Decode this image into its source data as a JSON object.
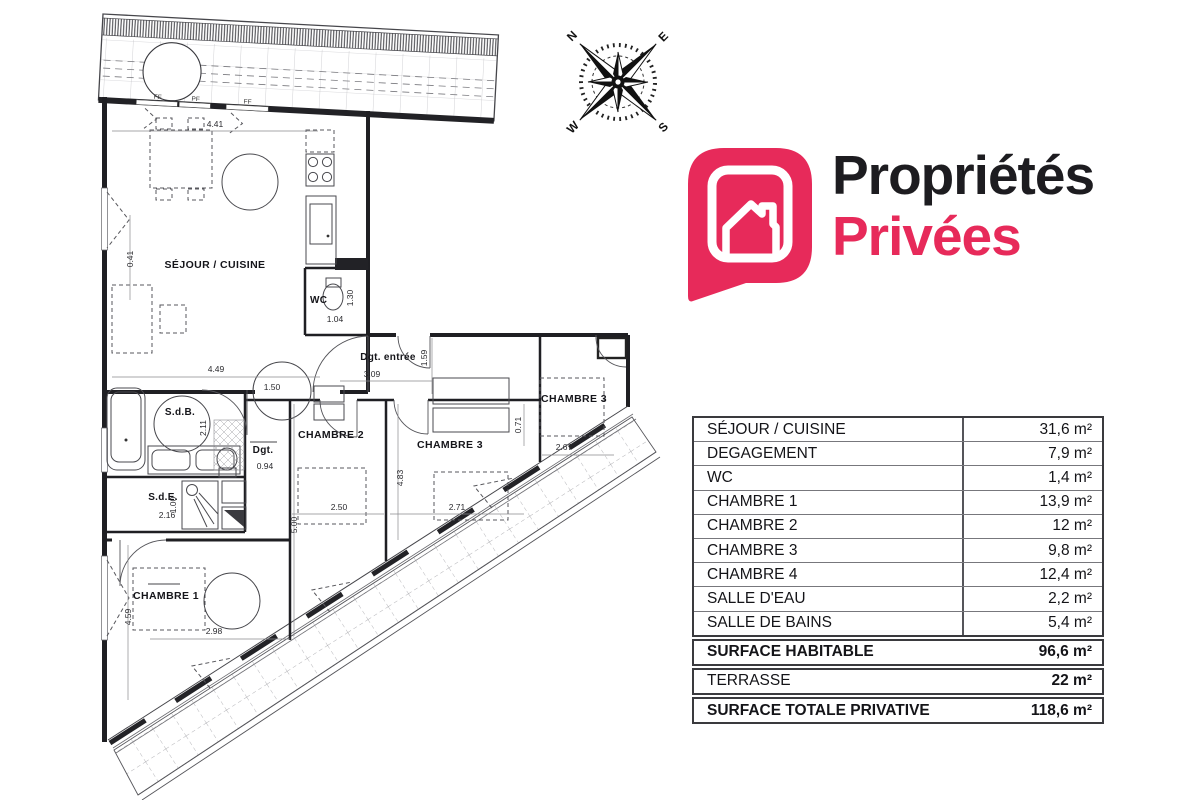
{
  "brand": {
    "name_line1": "Propriétés",
    "name_line2": "Privées",
    "primary_color": "#e72a5a",
    "text_color": "#1d1c20",
    "icon": "house-in-speech-bubble"
  },
  "compass": {
    "north": "N",
    "east": "E",
    "south": "S",
    "west": "W"
  },
  "plan": {
    "rooms": {
      "sejour": "SÉJOUR / CUISINE",
      "wc": "WC",
      "entry_hall": "Dgt. entrée",
      "bathroom": "S.d.B.",
      "hall": "Dgt.",
      "shower_room": "S.d.E.",
      "bedroom1": "CHAMBRE 1",
      "bedroom2": "CHAMBRE 2",
      "bedroom3": "CHAMBRE 3",
      "bedroom4": "CHAMBRE 3"
    },
    "dimensions": {
      "d441": "4.41",
      "d041": "0.41",
      "d449": "4.49",
      "d104": "1.04",
      "d130": "1.30",
      "d309": "3.09",
      "d159": "1.59",
      "d150": "1.50",
      "d211": "2.11",
      "d094": "0.94",
      "d216": "2.16",
      "d100": "1.00",
      "d250": "2.50",
      "d500": "5.00",
      "d483": "4.83",
      "d271": "2.71",
      "d267": "2.67",
      "d071": "0.71",
      "d459": "4.59",
      "d298": "2.98"
    },
    "window_marks": {
      "ff1": "FF",
      "pf": "PF",
      "ff2": "FF"
    }
  },
  "surface_table": {
    "unit": "m²",
    "rows": [
      {
        "label": "SÉJOUR / CUISINE",
        "value": "31,6 m²"
      },
      {
        "label": "DEGAGEMENT",
        "value": "7,9 m²"
      },
      {
        "label": "WC",
        "value": "1,4 m²"
      },
      {
        "label": "CHAMBRE 1",
        "value": "13,9 m²"
      },
      {
        "label": "CHAMBRE 2",
        "value": "12 m²"
      },
      {
        "label": "CHAMBRE 3",
        "value": "9,8 m²"
      },
      {
        "label": "CHAMBRE 4",
        "value": "12,4 m²"
      },
      {
        "label": "SALLE D'EAU",
        "value": "2,2 m²"
      },
      {
        "label": "SALLE DE BAINS",
        "value": "5,4 m²"
      }
    ],
    "summary": [
      {
        "label": "SURFACE HABITABLE",
        "value": "96,6 m²",
        "bold": true
      },
      {
        "label": "TERRASSE",
        "value": "22 m²",
        "bold": false
      },
      {
        "label": "SURFACE TOTALE PRIVATIVE",
        "value": "118,6 m²",
        "bold": true
      }
    ]
  }
}
